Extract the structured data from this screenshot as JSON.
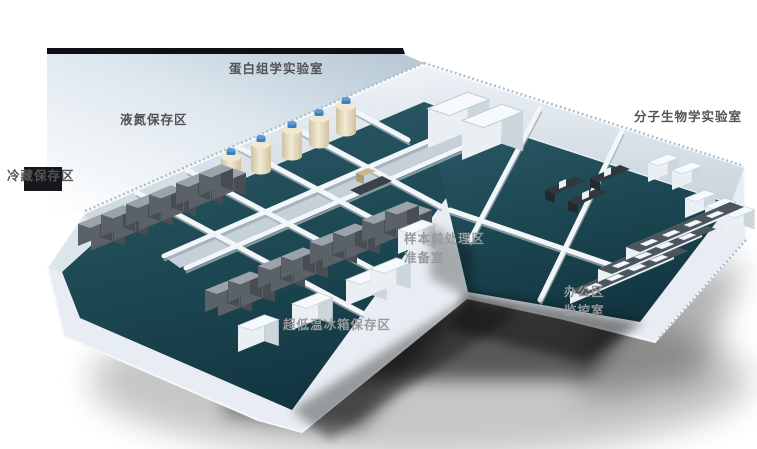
{
  "labels": {
    "proteomics_lab": "蛋白组学实验室",
    "liquid_nitrogen_area": "液氮保存区",
    "cold_storage_area": "冷藏保存区",
    "molecular_biology_lab": "分子生物学实验室",
    "sample_pretreatment_area": "样本前处理区",
    "preparation_room": "准备室",
    "office_area": "办公区",
    "monitoring_room": "监控室",
    "ult_freezer_area": "超低温冰箱保存区"
  },
  "colors": {
    "floor_teal": "#1c4752",
    "wall_light": "#e7edf2",
    "wall_shade": "#c9d5dc",
    "corridor_gray": "#c5d0d8",
    "freezer_gray": "#5a6167",
    "cabinet_white": "#e9eff3",
    "tank_cream": "#e9dfc6",
    "tank_cap_blue": "#3f7fc1",
    "bench_top": "#4d555c",
    "backdrop_strip": "#0e1013",
    "label_dark": "#515356",
    "label_on_shadow": "#97999c"
  }
}
